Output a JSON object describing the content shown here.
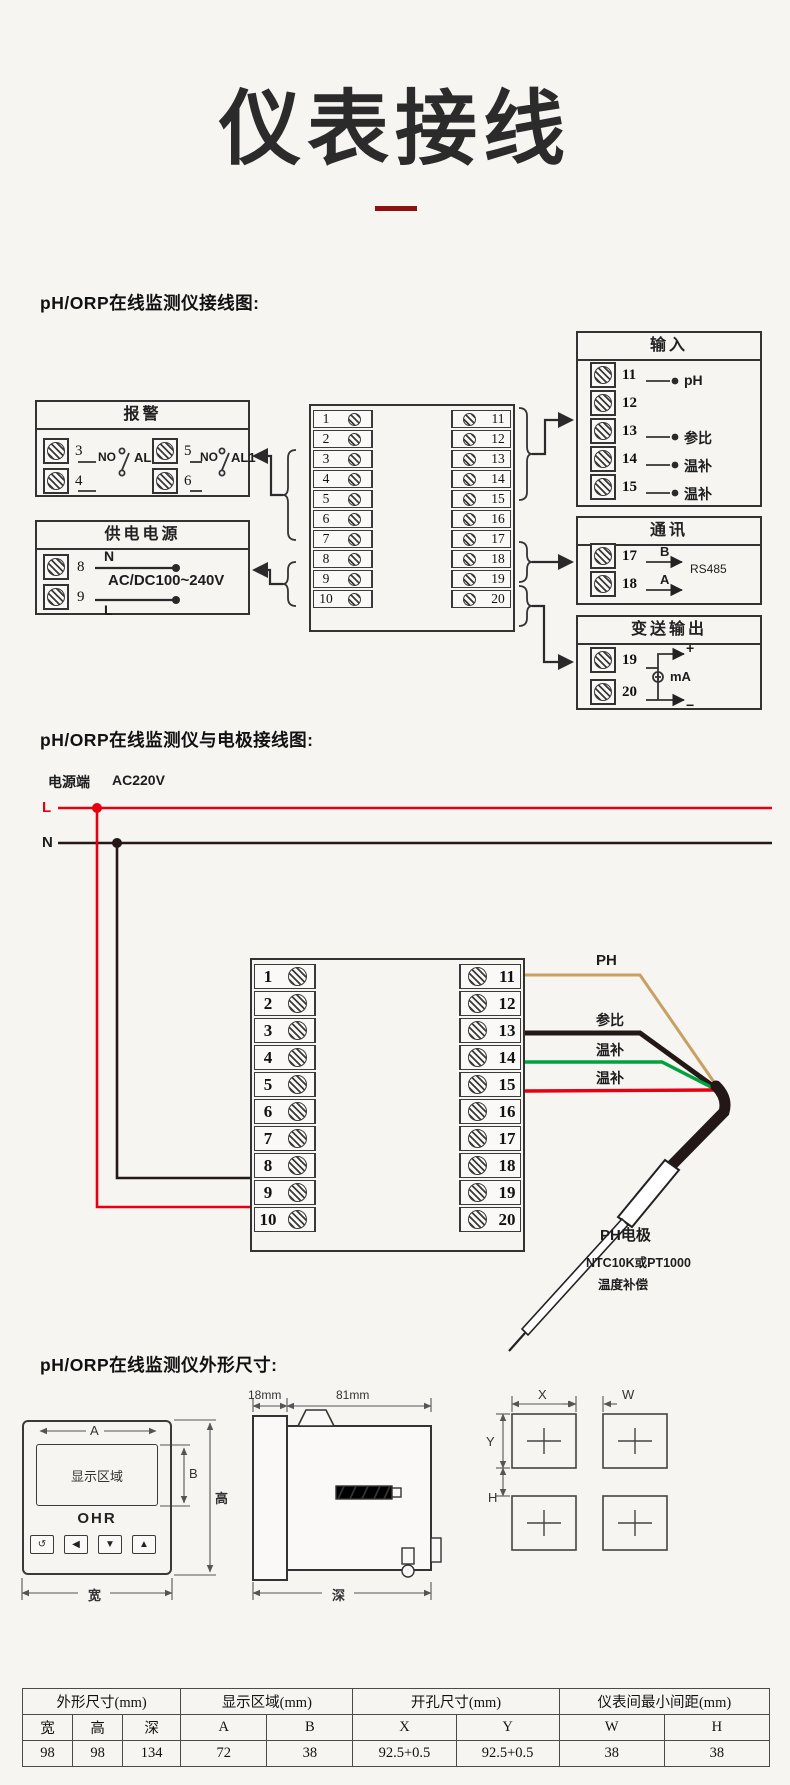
{
  "colors": {
    "maroon": "#8e1111",
    "wire-red": "#e60012",
    "wire-green": "#00a23e",
    "wire-tan": "#c9a063",
    "wire-black": "#231815"
  },
  "title": {
    "text": "仪表接线"
  },
  "s1": {
    "heading": "pH/ORP在线监测仪接线图:",
    "alarm": {
      "title": "报警",
      "groups": [
        {
          "t1": "3",
          "t2": "4",
          "no": "NO",
          "label": "AL2"
        },
        {
          "t1": "5",
          "t2": "6",
          "no": "NO",
          "label": "AL1"
        }
      ]
    },
    "power": {
      "title": "供电电源",
      "t1": "8",
      "t2": "9",
      "n": "N",
      "l": "L",
      "voltage": "AC/DC100~240V"
    },
    "blockA": {
      "left": [
        "1",
        "2",
        "3",
        "4",
        "5",
        "6",
        "7",
        "8",
        "9",
        "10"
      ],
      "right": [
        "11",
        "12",
        "13",
        "14",
        "15",
        "16",
        "17",
        "18",
        "19",
        "20"
      ]
    },
    "input": {
      "title": "输入",
      "rows": [
        {
          "num": "11",
          "label": "pH"
        },
        {
          "num": "12",
          "label": ""
        },
        {
          "num": "13",
          "label": "参比"
        },
        {
          "num": "14",
          "label": "温补"
        },
        {
          "num": "15",
          "label": "温补"
        }
      ]
    },
    "comm": {
      "title": "通讯",
      "rows": [
        {
          "num": "17",
          "letter": "B"
        },
        {
          "num": "18",
          "letter": "A"
        }
      ],
      "protocol": "RS485"
    },
    "transmit": {
      "title": "变送输出",
      "t1": "19",
      "t2": "20",
      "plus": "+",
      "minus": "−",
      "unit": "mA"
    }
  },
  "s2": {
    "heading": "pH/ORP在线监测仪与电极接线图:",
    "power_label": "电源端",
    "voltage": "AC220V",
    "live": "L",
    "neutral": "N",
    "blockB": {
      "left": [
        "1",
        "2",
        "3",
        "4",
        "5",
        "6",
        "7",
        "8",
        "9",
        "10"
      ],
      "right": [
        "11",
        "12",
        "13",
        "14",
        "15",
        "16",
        "17",
        "18",
        "19",
        "20"
      ]
    },
    "wires": [
      {
        "label": "PH"
      },
      {
        "label": "参比"
      },
      {
        "label": "温补"
      },
      {
        "label": "温补"
      }
    ],
    "electrode": {
      "name": "PH电极",
      "line1": "NTC10K或PT1000",
      "line2": "温度补偿"
    }
  },
  "s3": {
    "heading": "pH/ORP在线监测仪外形尺寸:",
    "front": {
      "display_label": "显示区域",
      "logo": "OHR",
      "buttons": [
        "↺",
        "◀",
        "▼",
        "▲"
      ],
      "dim_a": "A",
      "dim_b": "B",
      "dim_w": "宽",
      "dim_h": "高"
    },
    "side": {
      "front_depth": "18mm",
      "body_depth": "81mm",
      "dim_d": "深"
    },
    "cutout": {
      "x": "X",
      "y": "Y",
      "w": "W",
      "h": "H"
    },
    "table": {
      "groups": [
        "外形尺寸(mm)",
        "显示区域(mm)",
        "开孔尺寸(mm)",
        "仪表间最小间距(mm)"
      ],
      "cols": [
        "宽",
        "高",
        "深",
        "A",
        "B",
        "X",
        "Y",
        "W",
        "H"
      ],
      "values": [
        "98",
        "98",
        "134",
        "72",
        "38",
        "92.5+0.5",
        "92.5+0.5",
        "38",
        "38"
      ]
    }
  }
}
